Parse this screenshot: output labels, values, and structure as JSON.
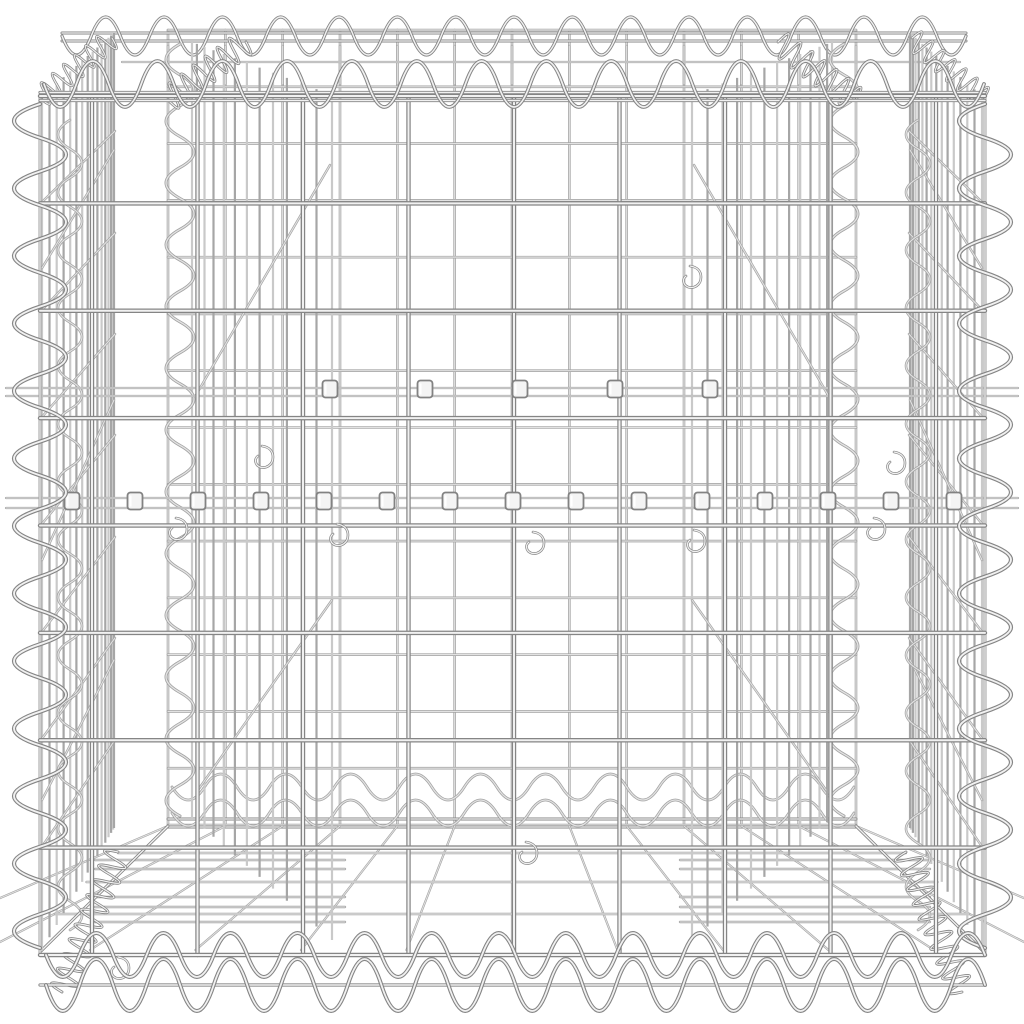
{
  "meta": {
    "subject": "Product photo of a silver galvanised steel gabion basket (welded wire mesh cube) with spiral edge bindings, internal partition panels, bracing wires and fastening clips, on a plain white background",
    "background": "#ffffff",
    "canvas": {
      "w": 1024,
      "h": 1024
    }
  },
  "palette": {
    "front_edge": "#858585",
    "front_core": "#f1f1f1",
    "mid_edge": "#a2a2a2",
    "mid_core": "#e2e2e2",
    "strip_dark": "#a6a6a6",
    "strip_light": "#c9c9c9",
    "clip_fill": "#f4f4f4",
    "clip_edge": "#828282"
  },
  "back_wall": {
    "x0": 168,
    "y0": 30,
    "x1": 856,
    "y1": 825,
    "cols": 12,
    "rows": 14,
    "w": 2.6
  },
  "front_wall": {
    "x0": 92,
    "y0": 96,
    "x1": 936,
    "y1": 955,
    "cols": 8,
    "rows": 8,
    "w": 4.4,
    "span_x0": 40,
    "span_x1": 985,
    "frame_verticals": [
      40,
      985
    ],
    "top_extra_ys": [
      92.5,
      100.5
    ],
    "bottom_extra_y": 985,
    "edge_w": 3.2
  },
  "lid": {
    "verticals_y0": 46,
    "verticals_y1": 84,
    "verticals_w": 2.6,
    "mid_wire": {
      "y": 62,
      "x0": 122,
      "x1": 960,
      "w": 2.2
    },
    "back_edge": {
      "ys": [
        33,
        41
      ],
      "x0": 62,
      "x1": 966,
      "w": 3.0
    }
  },
  "bottom": {
    "back_edge": {
      "ys": [
        819,
        827
      ],
      "x0": 168,
      "x1": 856,
      "w": 3.0
    },
    "back_waves": [
      {
        "y": 787,
        "x0": 172,
        "x1": 854,
        "period": 66,
        "amp": 13,
        "w": 2.8
      },
      {
        "y": 813,
        "x0": 172,
        "x1": 854,
        "period": 66,
        "amp": 13,
        "w": 2.8
      }
    ],
    "fan_verticals": {
      "y_back": 826,
      "y_front": 950,
      "scale": 1.84,
      "center_x": 512,
      "w": 2.2
    },
    "rungs_full": {
      "ys": [
        853,
        882,
        914
      ],
      "x_left": 150,
      "x_right": 874,
      "flare": 95,
      "w": 2.6
    },
    "rungs_left": {
      "ys": [
        860,
        869,
        897,
        907,
        922
      ],
      "x0": 95,
      "x1": 345,
      "w": 2.4
    },
    "rungs_right": {
      "ys": [
        860,
        869,
        897,
        907,
        922
      ],
      "x0": 680,
      "x1": 930,
      "w": 2.4
    },
    "diagonals": [
      {
        "x0": 40,
        "y0": 952,
        "x1": 168,
        "y1": 826
      },
      {
        "x0": 984,
        "y0": 952,
        "x1": 856,
        "y1": 826
      }
    ],
    "diagonal_w": 3.0
  },
  "strips": [
    {
      "name": "left-wall-mesh",
      "xa": 42,
      "xb": 114,
      "n": 16,
      "topA": 96,
      "topB": 33,
      "botA": 950,
      "botB": 828,
      "bias": 1.6,
      "w": 2.2
    },
    {
      "name": "right-wall-mesh",
      "xa": 982,
      "xb": 910,
      "n": 16,
      "topA": 96,
      "topB": 33,
      "botA": 950,
      "botB": 828,
      "bias": 1.6,
      "w": 2.2
    },
    {
      "name": "left-partition-mesh",
      "xa": 332,
      "xb": 192,
      "n": 13,
      "topA": 95,
      "topB": 42,
      "botA": 940,
      "botB": 818,
      "bias": 1.35,
      "w": 2.2
    },
    {
      "name": "right-partition-mesh",
      "xa": 692,
      "xb": 832,
      "n": 13,
      "topA": 95,
      "topB": 42,
      "botA": 940,
      "botB": 818,
      "bias": 1.35,
      "w": 2.2
    }
  ],
  "connectors": {
    "ys_front": [
      203,
      311,
      418,
      525,
      633,
      740,
      848
    ],
    "front_top": 96,
    "back_top": 30,
    "scale": 0.944,
    "left": {
      "xa": 41,
      "xb": 115
    },
    "right": {
      "xa": 983,
      "xb": 909
    },
    "w": 2.4
  },
  "braces": [
    {
      "x0": 114,
      "y0": 150,
      "x1": 42,
      "y1": 268
    },
    {
      "x0": 114,
      "y0": 400,
      "x1": 42,
      "y1": 560
    },
    {
      "x0": 114,
      "y0": 660,
      "x1": 42,
      "y1": 800
    },
    {
      "x0": 910,
      "y0": 150,
      "x1": 982,
      "y1": 268
    },
    {
      "x0": 910,
      "y0": 400,
      "x1": 982,
      "y1": 560
    },
    {
      "x0": 910,
      "y0": 660,
      "x1": 982,
      "y1": 800
    },
    {
      "x0": 330,
      "y0": 165,
      "x1": 196,
      "y1": 395
    },
    {
      "x0": 694,
      "y0": 165,
      "x1": 828,
      "y1": 395
    },
    {
      "x0": 332,
      "y0": 600,
      "x1": 198,
      "y1": 790
    },
    {
      "x0": 692,
      "y0": 600,
      "x1": 826,
      "y1": 790
    }
  ],
  "brace_w": 2.4,
  "wall_inner_spirals": [
    {
      "x": 70,
      "y0": 120,
      "y1": 930,
      "period": 58,
      "amp": 12,
      "w": 2.6
    },
    {
      "x": 918,
      "y0": 120,
      "y1": 930,
      "period": 58,
      "amp": 12,
      "w": 2.6
    }
  ],
  "partition_spirals": [
    {
      "x": 180,
      "y0": 44,
      "y1": 816,
      "period": 62,
      "amp": 14,
      "w": 3.0
    },
    {
      "x": 844,
      "y0": 44,
      "y1": 816,
      "period": 62,
      "amp": 14,
      "w": 3.0
    }
  ],
  "corner_spirals": [
    {
      "x": 40,
      "y0": 104,
      "y1": 948,
      "period": 68,
      "amp": 26,
      "w": 4.2
    },
    {
      "x": 985,
      "y0": 104,
      "y1": 948,
      "period": 68,
      "amp": 26,
      "w": 4.2
    }
  ],
  "top_spirals": [
    {
      "name": "top-back-edge-spiral",
      "y": 36,
      "x0": 62,
      "x1": 966,
      "period": 58,
      "amp": 19,
      "w": 3.2
    },
    {
      "name": "top-front-edge-spiral",
      "y": 84,
      "x0": 44,
      "x1": 984,
      "period": 64,
      "amp": 23,
      "w": 3.8
    }
  ],
  "bottom_spirals": [
    {
      "name": "bottom-front-spiral-upper",
      "y": 955,
      "x0": 46,
      "x1": 985,
      "period": 66,
      "amp": 22,
      "w": 4.0
    },
    {
      "name": "bottom-front-spiral-lower",
      "y": 985,
      "x0": 46,
      "x1": 985,
      "period": 66,
      "amp": 26,
      "w": 4.0
    }
  ],
  "coils": [
    {
      "name": "top-left-outer-coil",
      "x0": 40,
      "y0": 98,
      "x1": 112,
      "y1": 38,
      "period": 14,
      "amp": 11,
      "w": 2.6
    },
    {
      "name": "top-right-outer-coil",
      "x0": 984,
      "y0": 98,
      "x1": 912,
      "y1": 38,
      "period": 14,
      "amp": 11,
      "w": 2.6
    },
    {
      "name": "top-left-partition-coil",
      "x0": 168,
      "y0": 100,
      "x1": 246,
      "y1": 42,
      "period": 15,
      "amp": 13,
      "w": 2.8
    },
    {
      "name": "top-right-partition-coil",
      "x0": 856,
      "y0": 100,
      "x1": 778,
      "y1": 42,
      "period": 15,
      "amp": 13,
      "w": 2.8
    },
    {
      "name": "bottom-left-corner-coil",
      "x0": 118,
      "y0": 852,
      "x1": 62,
      "y1": 992,
      "period": 16,
      "amp": 13,
      "w": 2.8
    },
    {
      "name": "bottom-right-corner-coil",
      "x0": 906,
      "y0": 852,
      "x1": 962,
      "y1": 992,
      "period": 16,
      "amp": 13,
      "w": 2.8
    }
  ],
  "brace_rows": [
    {
      "y_a": 388,
      "y_b": 396,
      "x0": 6,
      "x1": 1018,
      "w": 2.2
    },
    {
      "y_a": 498,
      "y_b": 508,
      "x0": 6,
      "x1": 1018,
      "w": 2.2
    }
  ],
  "clips": [
    {
      "y": 501,
      "xs": [
        72,
        135,
        198,
        261,
        324,
        387,
        450,
        513,
        576,
        639,
        702,
        765,
        828,
        891,
        954
      ]
    },
    {
      "y": 389,
      "xs": [
        330,
        425,
        520,
        615,
        710
      ]
    }
  ],
  "clip_style": {
    "w": 15,
    "h": 17,
    "rx": 3
  },
  "hooks": [
    {
      "x": 176,
      "y": 518
    },
    {
      "x": 337,
      "y": 524
    },
    {
      "x": 533,
      "y": 532
    },
    {
      "x": 694,
      "y": 530
    },
    {
      "x": 874,
      "y": 518
    },
    {
      "x": 262,
      "y": 446
    },
    {
      "x": 690,
      "y": 266
    },
    {
      "x": 894,
      "y": 452
    },
    {
      "x": 118,
      "y": 957
    },
    {
      "x": 526,
      "y": 842
    }
  ],
  "hook_d": "c7,1 11,5 11,11 c0,8 -7,12 -13,10 c-5,-2 -6,-8 -2,-11"
}
